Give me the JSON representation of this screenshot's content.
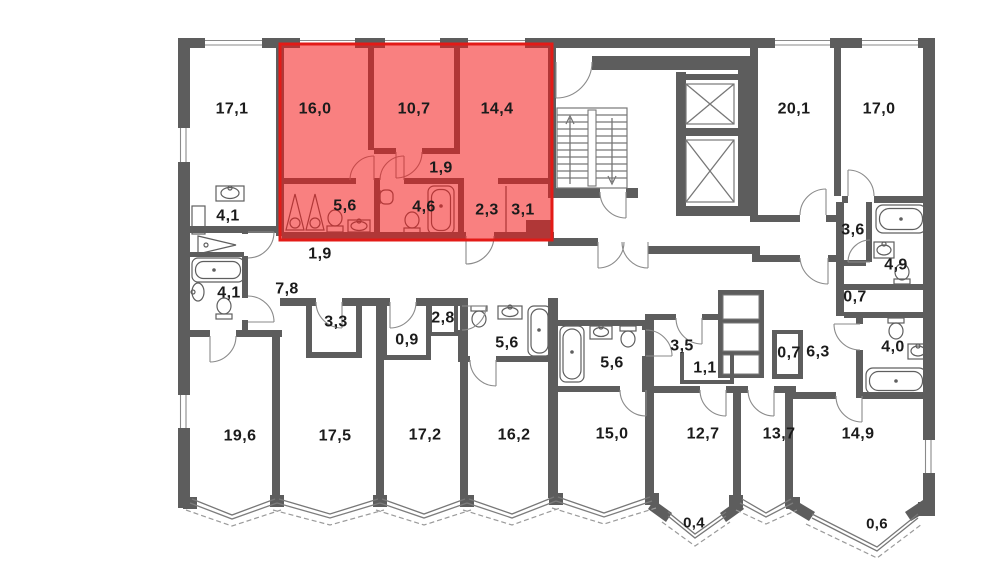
{
  "floor_plan": {
    "colors": {
      "wall": "#5d5d5d",
      "background": "#ffffff",
      "highlight_fill": "rgba(244,24,24,0.55)",
      "highlight_stroke": "#e31b17",
      "label": "#1b1b1b"
    },
    "highlighted_apartment": {
      "description": "selected apartment highlighted in red",
      "area_labels": [
        {
          "label": "16,0",
          "x": 315,
          "y": 109
        },
        {
          "label": "10,7",
          "x": 414,
          "y": 109
        },
        {
          "label": "14,4",
          "x": 497,
          "y": 109
        },
        {
          "label": "1,9",
          "x": 441,
          "y": 168
        },
        {
          "label": "5,6",
          "x": 345,
          "y": 206
        },
        {
          "label": "4,6",
          "x": 424,
          "y": 207
        },
        {
          "label": "2,3",
          "x": 487,
          "y": 210
        },
        {
          "label": "3,1",
          "x": 523,
          "y": 210
        }
      ]
    },
    "other_area_labels": [
      {
        "label": "17,1",
        "x": 232,
        "y": 109
      },
      {
        "label": "20,1",
        "x": 794,
        "y": 109
      },
      {
        "label": "17,0",
        "x": 879,
        "y": 109
      },
      {
        "label": "4,1",
        "x": 228,
        "y": 216
      },
      {
        "label": "1,9",
        "x": 320,
        "y": 254
      },
      {
        "label": "7,8",
        "x": 287,
        "y": 289
      },
      {
        "label": "4,1",
        "x": 229,
        "y": 293
      },
      {
        "label": "3,3",
        "x": 336,
        "y": 322
      },
      {
        "label": "0,9",
        "x": 407,
        "y": 340
      },
      {
        "label": "2,8",
        "x": 443,
        "y": 318
      },
      {
        "label": "5,6",
        "x": 507,
        "y": 343
      },
      {
        "label": "5,6",
        "x": 612,
        "y": 363
      },
      {
        "label": "3,5",
        "x": 682,
        "y": 346
      },
      {
        "label": "1,1",
        "x": 705,
        "y": 368
      },
      {
        "label": "3,6",
        "x": 853,
        "y": 230
      },
      {
        "label": "4,9",
        "x": 896,
        "y": 265
      },
      {
        "label": "0,7",
        "x": 855,
        "y": 297
      },
      {
        "label": "0,7",
        "x": 789,
        "y": 353
      },
      {
        "label": "6,3",
        "x": 818,
        "y": 352
      },
      {
        "label": "4,0",
        "x": 893,
        "y": 347
      },
      {
        "label": "19,6",
        "x": 240,
        "y": 436
      },
      {
        "label": "17,5",
        "x": 335,
        "y": 436
      },
      {
        "label": "17,2",
        "x": 425,
        "y": 435
      },
      {
        "label": "16,2",
        "x": 514,
        "y": 435
      },
      {
        "label": "15,0",
        "x": 612,
        "y": 434
      },
      {
        "label": "12,7",
        "x": 703,
        "y": 434
      },
      {
        "label": "13,7",
        "x": 779,
        "y": 434
      },
      {
        "label": "14,9",
        "x": 858,
        "y": 434
      }
    ],
    "balcony_labels": [
      {
        "label": "0,4",
        "x": 694,
        "y": 523
      },
      {
        "label": "0,6",
        "x": 877,
        "y": 524
      }
    ]
  }
}
